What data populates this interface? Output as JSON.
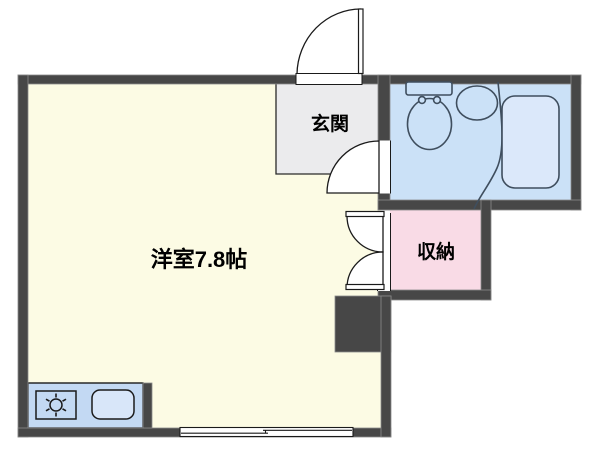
{
  "plan": {
    "rooms": {
      "main_room": {
        "label": "洋室7.8帖",
        "color": "#FCFBE4"
      },
      "entrance": {
        "label": "玄関",
        "color": "#EBEBED"
      },
      "storage": {
        "label": "収納",
        "color": "#F9DBE6"
      },
      "bathroom": {
        "color": "#CBE1F7"
      },
      "kitchen": {
        "color": "#C3D9F3"
      }
    },
    "colors": {
      "wall": "#474747",
      "wall_edge": "#8A8A8A",
      "line": "#1A1A1A",
      "fixture_stroke": "#3F4E5E",
      "bathtub_fill": "#DBE8FA",
      "kitchen_sink_fill": "#D8E6F9",
      "background": "#FFFFFF"
    },
    "fixtures": [
      "toilet-icon",
      "wash-basin-icon",
      "bathtub-icon",
      "stove-icon",
      "kitchen-sink-icon",
      "door-swing-icon",
      "sliding-window-icon"
    ]
  }
}
